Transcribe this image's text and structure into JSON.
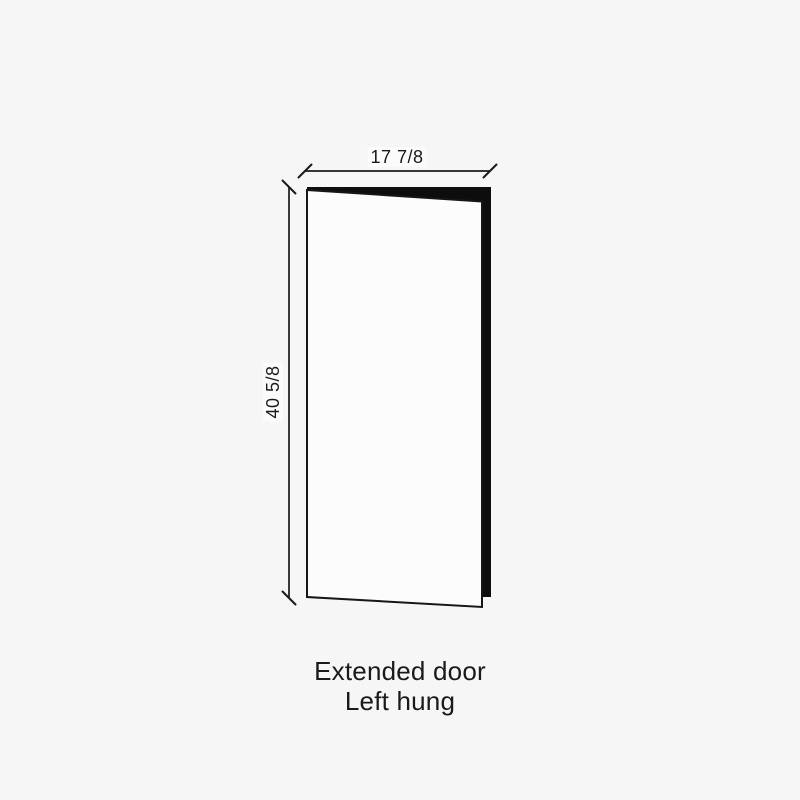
{
  "diagram": {
    "width_label": "17 7/8",
    "height_label": "40 5/8",
    "caption": {
      "line1": "Extended door",
      "line2": "Left hung"
    },
    "colors": {
      "background": "#f6f6f6",
      "line": "#1a1a1a",
      "text": "#1a1a1a",
      "door_face": "#fcfcfc",
      "door_edge": "#0d0d0d"
    }
  }
}
